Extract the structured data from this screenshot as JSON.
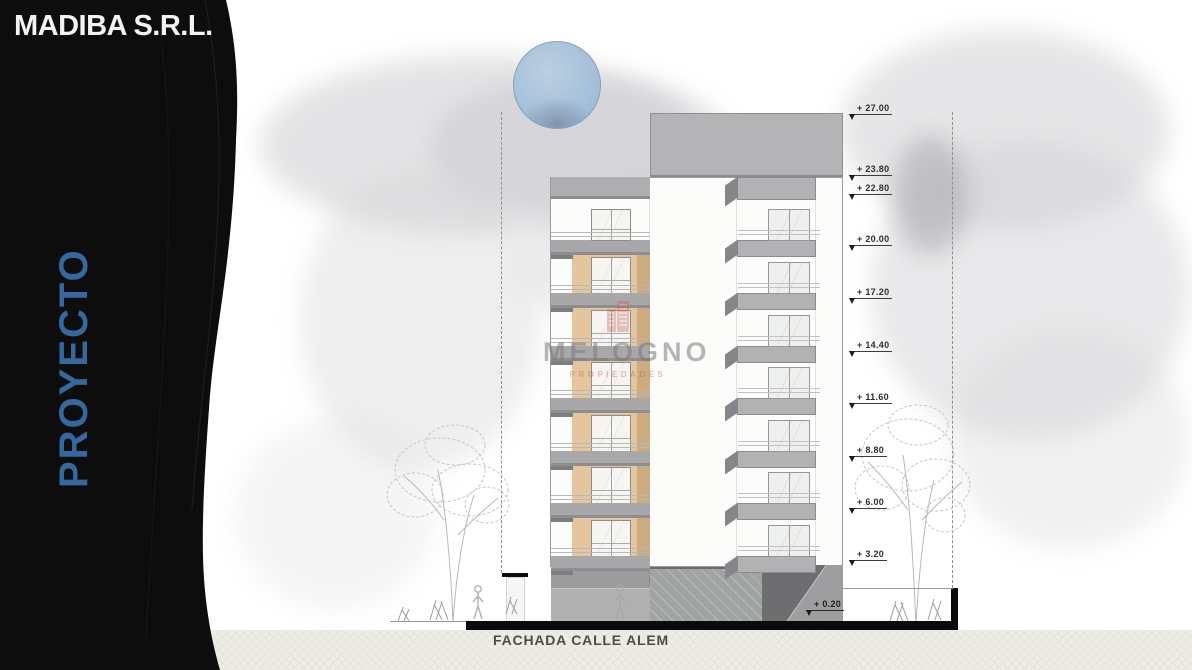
{
  "company": {
    "name": "MADIBA S.R.L.",
    "project_label": "PROYECTO"
  },
  "drawing": {
    "title": "FACHADA CALLE ALEM",
    "watermark": {
      "name": "MELOGNO",
      "subtext": "PROPIEDADES"
    },
    "elevation_markers": [
      {
        "label": "+ 27.00",
        "value": 27.0
      },
      {
        "label": "+ 23.80",
        "value": 23.8
      },
      {
        "label": "+ 22.80",
        "value": 22.8
      },
      {
        "label": "+ 20.00",
        "value": 20.0
      },
      {
        "label": "+ 17.20",
        "value": 17.2
      },
      {
        "label": "+ 14.40",
        "value": 14.4
      },
      {
        "label": "+ 11.60",
        "value": 11.6
      },
      {
        "label": "+ 8.80",
        "value": 8.8
      },
      {
        "label": "+ 6.00",
        "value": 6.0
      },
      {
        "label": "+ 3.20",
        "value": 3.2
      }
    ],
    "ground_marker": {
      "label": "+ 0.20",
      "value": 0.2
    },
    "building": {
      "upper_floors": 7,
      "tan_floors": 6,
      "balcony_rows": 7
    }
  },
  "colors": {
    "accent_blue": "#35689f",
    "wall_tan": "#e4c59e",
    "slab_gray": "#a8a8aa",
    "sun_blue": "#a9c3dc",
    "watermark_red": "#c35f55",
    "sidebar_black": "#0d0d0d"
  }
}
